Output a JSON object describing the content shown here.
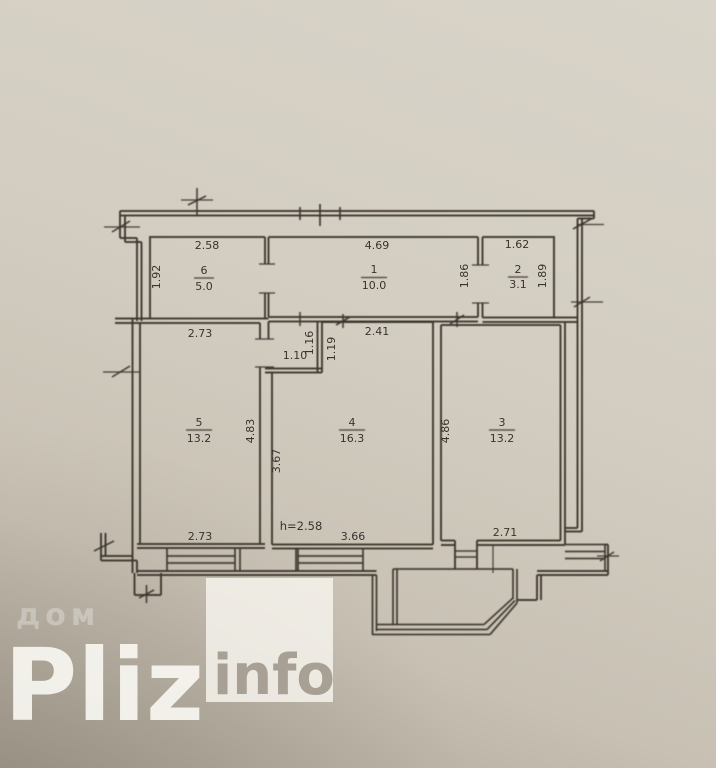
{
  "photo": {
    "paper_color": "#d3cdc1",
    "line_color": "#3a352e",
    "description_units": "meters"
  },
  "watermark": {
    "overlay_word": "дом",
    "brand": "Pliz",
    "brand_suffix": "info"
  },
  "plan": {
    "rooms": [
      {
        "number": "6",
        "area": "5.0",
        "dims": {
          "top": "2.58",
          "left": "1.92"
        }
      },
      {
        "number": "1",
        "area": "10.0",
        "dims": {
          "top": "4.69",
          "right": "1.86"
        }
      },
      {
        "number": "2",
        "area": "3.1",
        "dims": {
          "top": "1.62",
          "right": "1.89"
        }
      },
      {
        "number": "5",
        "area": "13.2",
        "dims": {
          "top": "2.73",
          "bottom": "2.73",
          "right": "4.83"
        }
      },
      {
        "number": "4",
        "area": "16.3",
        "dims": {
          "top": "2.41",
          "left": "3.67",
          "bottom": "3.66",
          "nook_width": "1.10",
          "nook_outer": "1.16",
          "nook_inner": "1.19"
        },
        "height_note": "h=2.58"
      },
      {
        "number": "3",
        "area": "13.2",
        "dims": {
          "left": "4.86",
          "bottom": "2.71"
        }
      }
    ]
  }
}
